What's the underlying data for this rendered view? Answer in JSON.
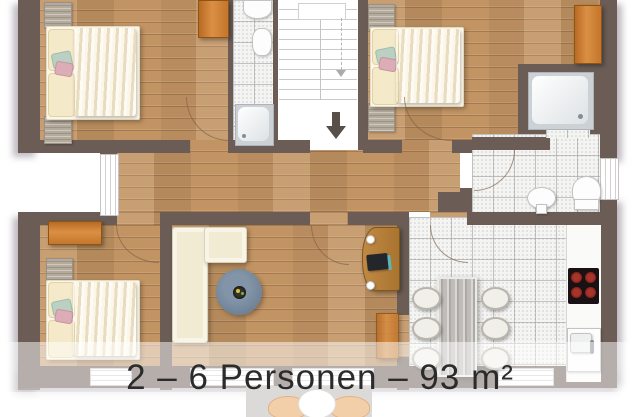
{
  "caption": {
    "text": "2 – 6 Personen – 93 m²",
    "occupancy": "2 – 6 Personen",
    "area": "93 m²"
  },
  "palette": {
    "wall": "#6b5d56",
    "wood": "#c29463",
    "wood-accent": "#c97c33",
    "tile": "#f4f4f2",
    "rug": "#6e8095",
    "sofa": "#f2ebd3",
    "bed": "#f0e0ae",
    "counter": "#fafaf9",
    "cooktop": "#1a1114",
    "burner": "#7e1d18",
    "caption-text": "#2b2b2b",
    "overlay": "rgba(255,255,255,0.5)"
  },
  "plan": {
    "rooms": [
      "bedroom-1",
      "bedroom-2",
      "bedroom-3",
      "small-bathroom",
      "shower-bathroom",
      "hallway",
      "stairwell",
      "living-room",
      "kitchen-dining"
    ],
    "furniture": [
      "double-bed",
      "double-bed",
      "double-bed",
      "wardrobe",
      "wardrobe",
      "wardrobe",
      "l-shaped-sofa",
      "round-rug",
      "desk-with-laptop",
      "dining-table",
      "six-chairs",
      "cooktop",
      "kitchen-sink",
      "shower-tray",
      "shower-tray",
      "toilet",
      "pedestal-sink",
      "washbasin"
    ],
    "icons": [
      "down-arrow-icon",
      "stair-direction-arrow-icon"
    ]
  }
}
